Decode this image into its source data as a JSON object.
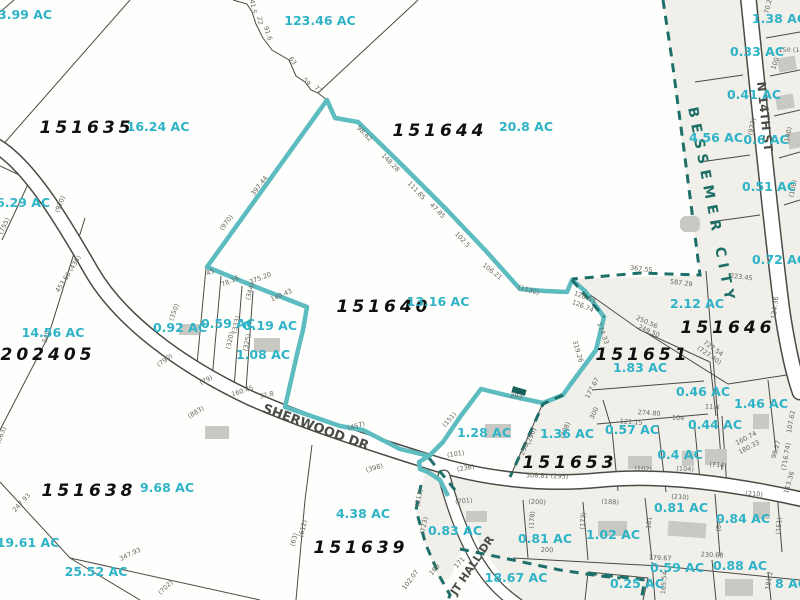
{
  "map": {
    "colors": {
      "background": "#fefefc",
      "city_region_fill": "#f0efea",
      "parcel_line": "#4a4a45",
      "highlight_boundary": "#5cbcc0",
      "city_boundary": "#1e6f6a",
      "acreage_text": "#2fb3c7",
      "parcel_id_text": "#101010",
      "dimension_text": "#66665e",
      "road_label_text": "#4c4c46",
      "city_label_text": "#1d6f66",
      "road_fill": "#ffffff",
      "building_fill": "#c9c9c4"
    },
    "highlighted_parcel": {
      "id": "151640",
      "acreage": "13.16 AC"
    },
    "city_label": [
      {
        "text": "BESSEMER CITY",
        "x": 688,
        "y": 108,
        "rot": 79,
        "anchor": "start"
      }
    ],
    "street_labels": [
      {
        "text": "SHERWOOD DR",
        "x": 262,
        "y": 412,
        "rot": 20,
        "size": 13,
        "anchor": "start"
      },
      {
        "text": "JT HALL DR",
        "x": 456,
        "y": 596,
        "rot": -56,
        "size": 11,
        "anchor": "start"
      },
      {
        "text": "N 14TH ST",
        "x": 757,
        "y": 82,
        "rot": 84,
        "size": 12,
        "anchor": "start"
      }
    ],
    "parcel_ids": [
      {
        "text": "151635",
        "x": 87,
        "y": 133
      },
      {
        "text": "151644",
        "x": 440,
        "y": 136
      },
      {
        "text": "151640",
        "x": 384,
        "y": 312,
        "size": 19
      },
      {
        "text": "202405",
        "x": 48,
        "y": 360
      },
      {
        "text": "151638",
        "x": 89,
        "y": 496
      },
      {
        "text": "151639",
        "x": 361,
        "y": 553
      },
      {
        "text": "151646",
        "x": 728,
        "y": 333
      },
      {
        "text": "151651",
        "x": 643,
        "y": 360
      },
      {
        "text": "151653",
        "x": 570,
        "y": 468
      }
    ],
    "acreage_labels": [
      {
        "text": "3.99 AC",
        "x": -2,
        "y": 19,
        "anchor": "start"
      },
      {
        "text": "123.46 AC",
        "x": 320,
        "y": 25
      },
      {
        "text": "16.24 AC",
        "x": 158,
        "y": 131
      },
      {
        "text": "20.8 AC",
        "x": 526,
        "y": 131
      },
      {
        "text": "6.29 AC",
        "x": -4,
        "y": 207,
        "anchor": "start"
      },
      {
        "text": "13.16 AC",
        "x": 438,
        "y": 306
      },
      {
        "text": "14.56 AC",
        "x": 53,
        "y": 337
      },
      {
        "text": "0.92 AC",
        "x": 180,
        "y": 332
      },
      {
        "text": "0.59 AC",
        "x": 228,
        "y": 328
      },
      {
        "text": "0.19 AC",
        "x": 270,
        "y": 330
      },
      {
        "text": "1.08 AC",
        "x": 263,
        "y": 359
      },
      {
        "text": "1.28 AC",
        "x": 484,
        "y": 437
      },
      {
        "text": "1.36 AC",
        "x": 567,
        "y": 438
      },
      {
        "text": "0.57 AC",
        "x": 632,
        "y": 434
      },
      {
        "text": "0.4 AC",
        "x": 680,
        "y": 459
      },
      {
        "text": "0.44 AC",
        "x": 715,
        "y": 429
      },
      {
        "text": "0.46 AC",
        "x": 703,
        "y": 396
      },
      {
        "text": "1.83 AC",
        "x": 640,
        "y": 372
      },
      {
        "text": "2.12 AC",
        "x": 697,
        "y": 308
      },
      {
        "text": "1.46 AC",
        "x": 761,
        "y": 408
      },
      {
        "text": "0.72 AC",
        "x": 779,
        "y": 264
      },
      {
        "text": "1.38 AC",
        "x": 779,
        "y": 23
      },
      {
        "text": "0.33 AC",
        "x": 757,
        "y": 56
      },
      {
        "text": "0.41 AC",
        "x": 754,
        "y": 99
      },
      {
        "text": "4.56 AC",
        "x": 716,
        "y": 142
      },
      {
        "text": "0.6 AC",
        "x": 766,
        "y": 144
      },
      {
        "text": "0.51 AC",
        "x": 769,
        "y": 191
      },
      {
        "text": "0.81 AC",
        "x": 545,
        "y": 543
      },
      {
        "text": "1.02 AC",
        "x": 613,
        "y": 539
      },
      {
        "text": "0.81 AC",
        "x": 681,
        "y": 512
      },
      {
        "text": "0.84 AC",
        "x": 743,
        "y": 523
      },
      {
        "text": "0.83 AC",
        "x": 455,
        "y": 535
      },
      {
        "text": "4.38 AC",
        "x": 363,
        "y": 518
      },
      {
        "text": "9.68 AC",
        "x": 167,
        "y": 492
      },
      {
        "text": "19.61 AC",
        "x": 28,
        "y": 547
      },
      {
        "text": "25.52 AC",
        "x": 96,
        "y": 576
      },
      {
        "text": "18.67 AC",
        "x": 516,
        "y": 582
      },
      {
        "text": "0.59 AC",
        "x": 677,
        "y": 572
      },
      {
        "text": "0.88 AC",
        "x": 740,
        "y": 570
      },
      {
        "text": "0.25 AC",
        "x": 637,
        "y": 588
      },
      {
        "text": "8 AC",
        "x": 791,
        "y": 588
      }
    ],
    "dimension_labels": [
      {
        "text": "41.5",
        "x": 251,
        "y": 7,
        "rot": 80
      },
      {
        "text": "22",
        "x": 258,
        "y": 21,
        "rot": 80
      },
      {
        "text": "91.6",
        "x": 266,
        "y": 34,
        "rot": 72
      },
      {
        "text": "63",
        "x": 291,
        "y": 62,
        "rot": 55
      },
      {
        "text": "59",
        "x": 305,
        "y": 83,
        "rot": 50
      },
      {
        "text": "77",
        "x": 317,
        "y": 91,
        "rot": 40
      },
      {
        "text": "397.44",
        "x": 261,
        "y": 187,
        "rot": -52
      },
      {
        "text": "(970)",
        "x": 228,
        "y": 224,
        "rot": -52
      },
      {
        "text": "98.62",
        "x": 363,
        "y": 135,
        "rot": 46
      },
      {
        "text": "148.28",
        "x": 389,
        "y": 164,
        "rot": 46
      },
      {
        "text": "111.85",
        "x": 415,
        "y": 192,
        "rot": 46
      },
      {
        "text": "47.85",
        "x": 436,
        "y": 212,
        "rot": 46
      },
      {
        "text": "102.5",
        "x": 461,
        "y": 241,
        "rot": 46
      },
      {
        "text": "106.21",
        "x": 491,
        "y": 273,
        "rot": 38
      },
      {
        "text": "(1130)",
        "x": 528,
        "y": 292,
        "rot": 16
      },
      {
        "text": "126.53",
        "x": 584,
        "y": 299,
        "rot": 22
      },
      {
        "text": "126.74",
        "x": 582,
        "y": 308,
        "rot": 22
      },
      {
        "text": "174.33",
        "x": 601,
        "y": 334,
        "rot": 70
      },
      {
        "text": "319.26",
        "x": 576,
        "y": 352,
        "rot": 73
      },
      {
        "text": "177.67",
        "x": 594,
        "y": 389,
        "rot": -62
      },
      {
        "text": "300",
        "x": 596,
        "y": 414,
        "rot": -64
      },
      {
        "text": "367.55",
        "x": 641,
        "y": 271,
        "rot": 7
      },
      {
        "text": "587.29",
        "x": 681,
        "y": 285,
        "rot": 7
      },
      {
        "text": "223.45",
        "x": 741,
        "y": 279,
        "rot": 7
      },
      {
        "text": "250.56",
        "x": 646,
        "y": 324,
        "rot": 24
      },
      {
        "text": "249.50",
        "x": 648,
        "y": 333,
        "rot": 24
      },
      {
        "text": "134.36",
        "x": 777,
        "y": 308,
        "rot": -82
      },
      {
        "text": "727.54",
        "x": 712,
        "y": 350,
        "rot": 35
      },
      {
        "text": "(727.40)",
        "x": 708,
        "y": 357,
        "rot": 35
      },
      {
        "text": "160.74",
        "x": 747,
        "y": 440,
        "rot": -28
      },
      {
        "text": "180.33",
        "x": 750,
        "y": 449,
        "rot": -28
      },
      {
        "text": "98.27",
        "x": 778,
        "y": 450,
        "rot": -74
      },
      {
        "text": "113.36",
        "x": 791,
        "y": 483,
        "rot": -74
      },
      {
        "text": "107.62",
        "x": 793,
        "y": 422,
        "rot": -80
      },
      {
        "text": "(716.74)",
        "x": 788,
        "y": 457,
        "rot": -80
      },
      {
        "text": "274.80",
        "x": 649,
        "y": 415,
        "rot": 4
      },
      {
        "text": "11.4",
        "x": 712,
        "y": 409,
        "rot": 4
      },
      {
        "text": "104",
        "x": 678,
        "y": 420,
        "rot": 4
      },
      {
        "text": "121.15",
        "x": 631,
        "y": 424,
        "rot": 4
      },
      {
        "text": "(102)",
        "x": 643,
        "y": 471,
        "rot": 3
      },
      {
        "text": "(104)",
        "x": 685,
        "y": 471,
        "rot": 3
      },
      {
        "text": "(714)",
        "x": 718,
        "y": 467,
        "rot": 3
      },
      {
        "text": "(173)",
        "x": 585,
        "y": 521,
        "rot": -85
      },
      {
        "text": "(178)",
        "x": 534,
        "y": 520,
        "rot": -85
      },
      {
        "text": "(200)",
        "x": 537,
        "y": 504,
        "rot": 3
      },
      {
        "text": "(188)",
        "x": 610,
        "y": 504,
        "rot": 3
      },
      {
        "text": "(210)",
        "x": 680,
        "y": 499,
        "rot": 3
      },
      {
        "text": "(210)",
        "x": 754,
        "y": 496,
        "rot": 3
      },
      {
        "text": "161",
        "x": 651,
        "y": 523,
        "rot": -85
      },
      {
        "text": "(84)",
        "x": 721,
        "y": 525,
        "rot": -85
      },
      {
        "text": "(151)",
        "x": 781,
        "y": 526,
        "rot": -85
      },
      {
        "text": "179.67",
        "x": 660,
        "y": 560,
        "rot": 3
      },
      {
        "text": "230.68",
        "x": 712,
        "y": 557,
        "rot": 3
      },
      {
        "text": "165.54",
        "x": 666,
        "y": 583,
        "rot": -85
      },
      {
        "text": "181.2",
        "x": 771,
        "y": 581,
        "rot": -80
      },
      {
        "text": "(236)",
        "x": 466,
        "y": 470,
        "rot": -10
      },
      {
        "text": "308.81 (295)",
        "x": 547,
        "y": 478,
        "rot": 2
      },
      {
        "text": "203",
        "x": 516,
        "y": 398,
        "rot": 8
      },
      {
        "text": "(151)",
        "x": 451,
        "y": 421,
        "rot": -48
      },
      {
        "text": "(296)",
        "x": 533,
        "y": 437,
        "rot": -68
      },
      {
        "text": "258",
        "x": 526,
        "y": 450,
        "rot": -68
      },
      {
        "text": "(408)",
        "x": 567,
        "y": 431,
        "rot": -68
      },
      {
        "text": "(920)",
        "x": 62,
        "y": 205,
        "rot": -68
      },
      {
        "text": "(755)",
        "x": 6,
        "y": 227,
        "rot": -64
      },
      {
        "text": "453.66 (436)",
        "x": 70,
        "y": 275,
        "rot": -58
      },
      {
        "text": "540",
        "x": 48,
        "y": 337,
        "rot": -76
      },
      {
        "text": "(663)",
        "x": 3,
        "y": 436,
        "rot": -68
      },
      {
        "text": "247.93",
        "x": 23,
        "y": 504,
        "rot": -48
      },
      {
        "text": "347.93",
        "x": 131,
        "y": 556,
        "rot": -26
      },
      {
        "text": "(702)",
        "x": 167,
        "y": 589,
        "rot": -44
      },
      {
        "text": "(790)",
        "x": 166,
        "y": 362,
        "rot": -36
      },
      {
        "text": "(79)",
        "x": 207,
        "y": 382,
        "rot": -26
      },
      {
        "text": "160.45",
        "x": 243,
        "y": 393,
        "rot": -18
      },
      {
        "text": "32.8",
        "x": 267,
        "y": 397,
        "rot": -14
      },
      {
        "text": "(883)",
        "x": 197,
        "y": 414,
        "rot": -32
      },
      {
        "text": "45",
        "x": 211,
        "y": 274,
        "rot": -24
      },
      {
        "text": "78.16",
        "x": 231,
        "y": 283,
        "rot": -24
      },
      {
        "text": "(344)",
        "x": 252,
        "y": 292,
        "rot": -74
      },
      {
        "text": "375.20",
        "x": 261,
        "y": 280,
        "rot": -21
      },
      {
        "text": "140.43",
        "x": 282,
        "y": 297,
        "rot": -24
      },
      {
        "text": "(350)",
        "x": 176,
        "y": 313,
        "rot": -70
      },
      {
        "text": "(333)",
        "x": 238,
        "y": 325,
        "rot": -78
      },
      {
        "text": "(320)",
        "x": 232,
        "y": 341,
        "rot": -78
      },
      {
        "text": "(325)",
        "x": 249,
        "y": 343,
        "rot": -78
      },
      {
        "text": "(457)",
        "x": 357,
        "y": 428,
        "rot": -17
      },
      {
        "text": "(398)",
        "x": 375,
        "y": 470,
        "rot": -17
      },
      {
        "text": "(101)",
        "x": 456,
        "y": 456,
        "rot": -8
      },
      {
        "text": "(701)",
        "x": 464,
        "y": 503,
        "rot": -6
      },
      {
        "text": "171",
        "x": 461,
        "y": 564,
        "rot": -48
      },
      {
        "text": "160",
        "x": 436,
        "y": 571,
        "rot": -48
      },
      {
        "text": "102.07",
        "x": 412,
        "y": 581,
        "rot": -53
      },
      {
        "text": "(723)",
        "x": 426,
        "y": 526,
        "rot": -78
      },
      {
        "text": "(63)",
        "x": 296,
        "y": 540,
        "rot": -76
      },
      {
        "text": "(612)",
        "x": 305,
        "y": 529,
        "rot": -76
      },
      {
        "text": "70.2",
        "x": 770,
        "y": 7,
        "rot": -76
      },
      {
        "text": "150  (14",
        "x": 791,
        "y": 52,
        "rot": 0
      },
      {
        "text": "100",
        "x": 777,
        "y": 64,
        "rot": -72
      },
      {
        "text": "(922)",
        "x": 754,
        "y": 127,
        "rot": -78
      },
      {
        "text": "(140)",
        "x": 790,
        "y": 136,
        "rot": -78
      },
      {
        "text": "(108)",
        "x": 795,
        "y": 189,
        "rot": -78
      },
      {
        "text": "(213)",
        "x": 421,
        "y": 498,
        "rot": -78
      },
      {
        "text": "200",
        "x": 547,
        "y": 552,
        "rot": 2
      }
    ]
  }
}
